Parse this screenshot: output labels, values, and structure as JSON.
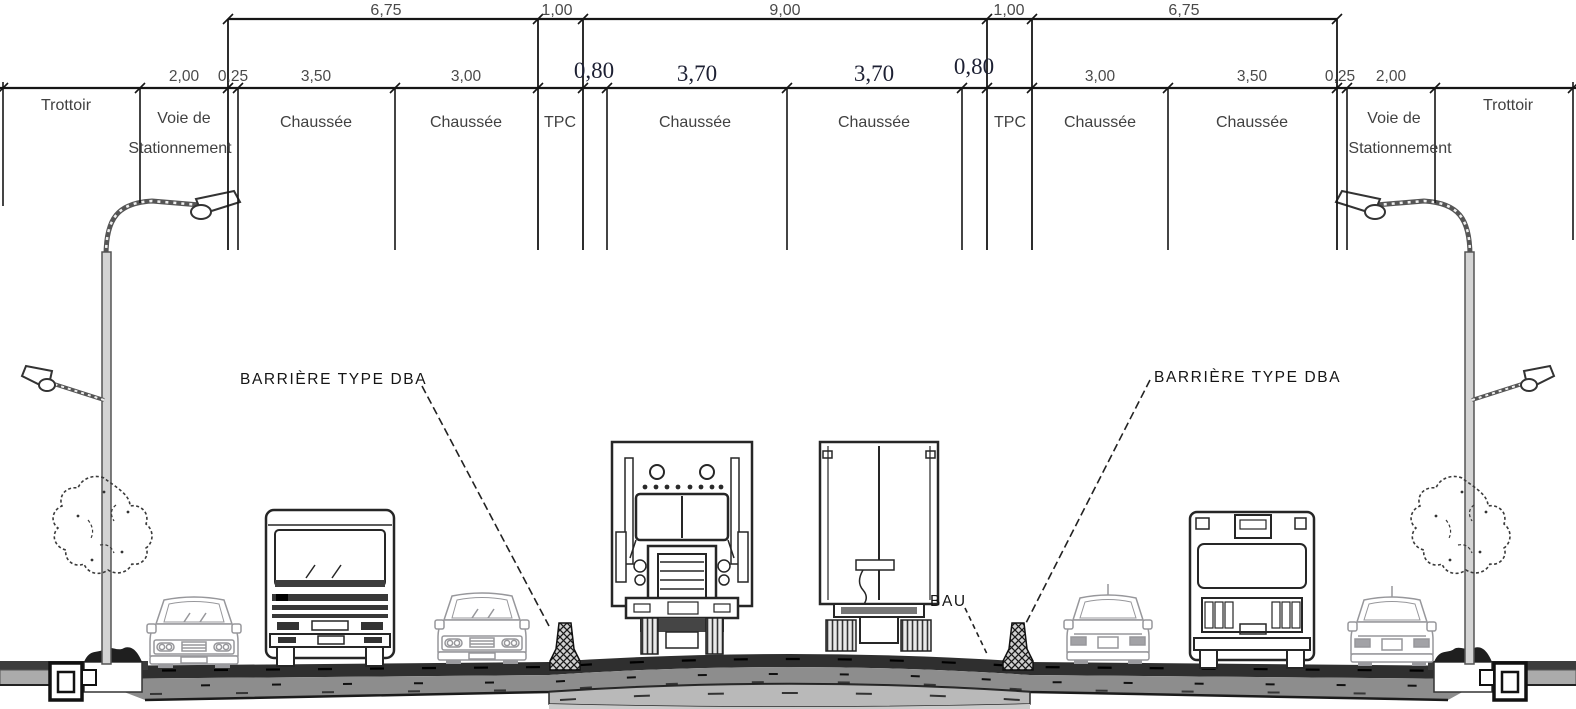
{
  "dimensions": {
    "top": [
      "6,75",
      "1,00",
      "9,00",
      "1,00",
      "6,75"
    ],
    "sub": [
      "2,00",
      "0,25",
      "3,50",
      "3,00",
      "0,80",
      "3,70",
      "3,70",
      "0,80",
      "3,00",
      "3,50",
      "0,25",
      "2,00"
    ]
  },
  "zones": [
    "Trottoir",
    "Voie de",
    "Stationnement",
    "Chaussée",
    "Chaussée",
    "TPC",
    "Chaussée",
    "Chaussée",
    "TPC",
    "Chaussée",
    "Chaussée",
    "Voie de",
    "Stationnement",
    "Trottoir"
  ],
  "annotations": {
    "barriere_left": "BARRIÈRE TYPE DBA",
    "barriere_right": "BARRIÈRE TYPE DBA",
    "bau": "BAU"
  },
  "colors": {
    "line": "#161616",
    "asphalt": "#2f2f2f",
    "subbase": "#8d8d8d",
    "deck": "#b9b9b9",
    "serif_dim": "#1d2033"
  }
}
